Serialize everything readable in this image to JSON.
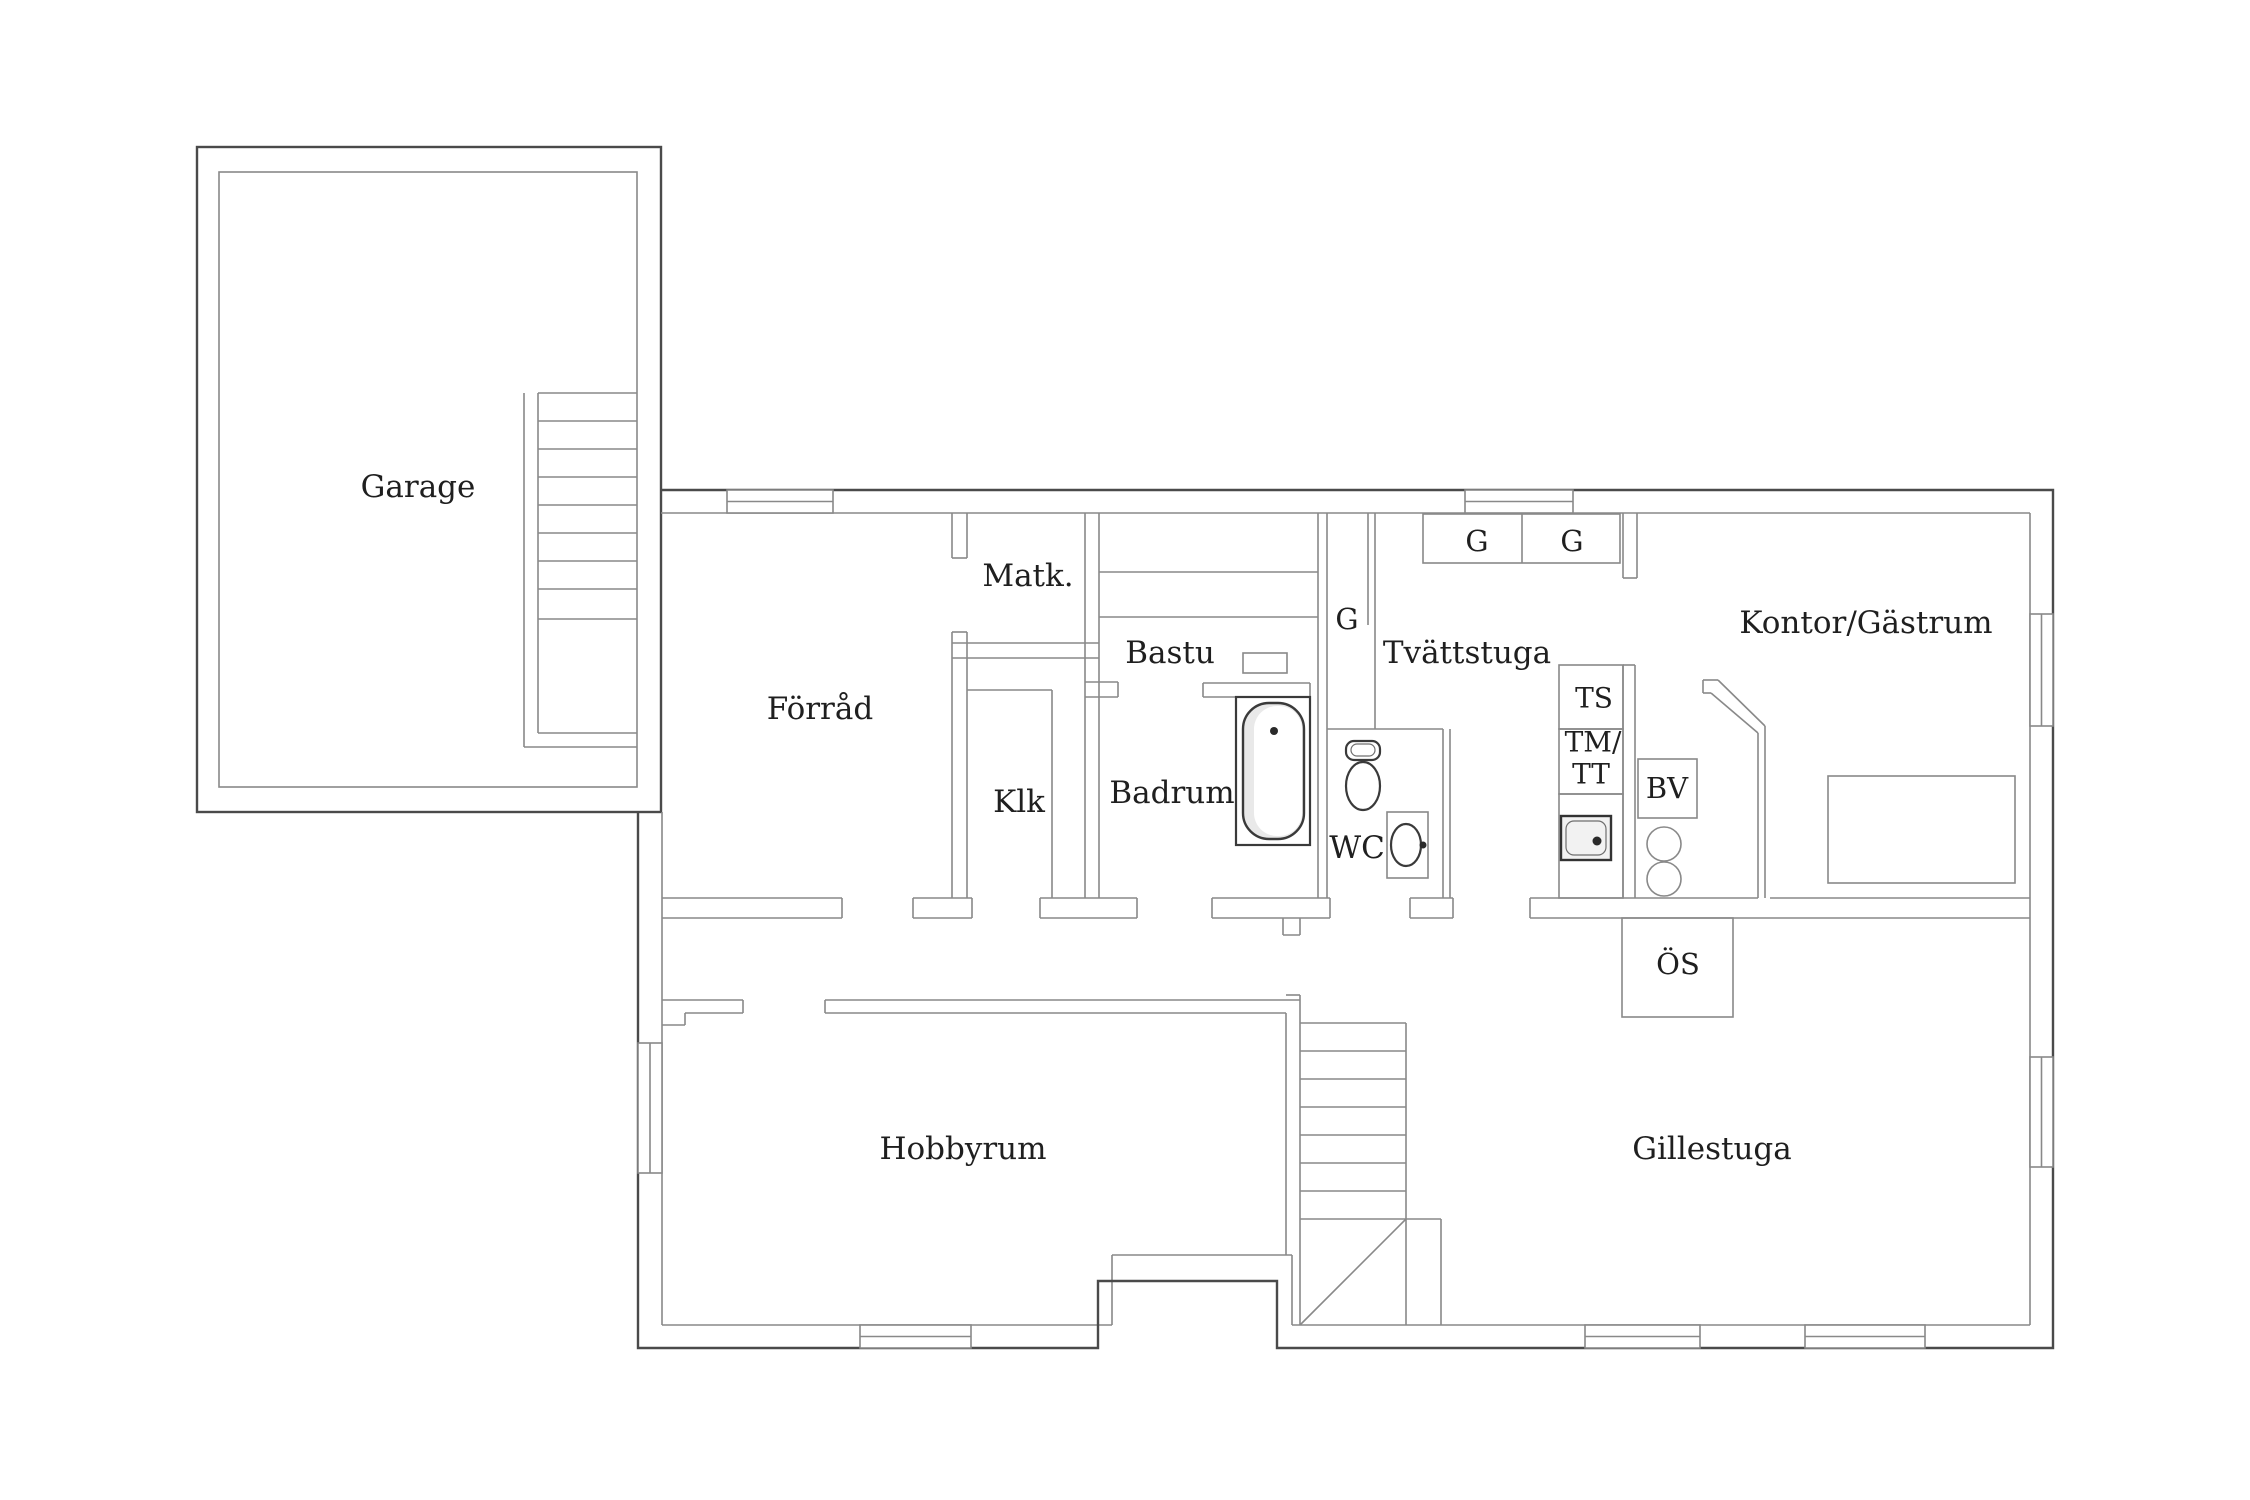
{
  "title": "Basement floor plan",
  "colors": {
    "background": "#ffffff",
    "wall": "#898989",
    "wall_dark": "#4a4a4a",
    "text": "#1f1f1f",
    "fixture_fill": "#e9e9e9"
  },
  "rooms": {
    "garage": "Garage",
    "forrad": "Förråd",
    "matk": "Matk.",
    "bastu": "Bastu",
    "klk": "Klk",
    "badrum": "Badrum",
    "wc": "WC",
    "g_closet": "G",
    "tvattstuga": "Tvättstuga",
    "g1": "G",
    "g2": "G",
    "ts": "TS",
    "tm1": "TM/",
    "tm2": "TT",
    "bv": "BV",
    "os": "ÖS",
    "kontor": "Kontor/Gästrum",
    "gillestuga": "Gillestuga",
    "hobbyrum": "Hobbyrum"
  },
  "plan": {
    "width": 2250,
    "height": 1500,
    "labels": [
      {
        "key": "garage",
        "x": 418,
        "y": 487,
        "size": 31
      },
      {
        "key": "forrad",
        "x": 820,
        "y": 709,
        "size": 31
      },
      {
        "key": "matk",
        "x": 1028,
        "y": 576,
        "size": 31
      },
      {
        "key": "bastu",
        "x": 1170,
        "y": 653,
        "size": 31
      },
      {
        "key": "klk",
        "x": 1019,
        "y": 802,
        "size": 31
      },
      {
        "key": "badrum",
        "x": 1172,
        "y": 793,
        "size": 31
      },
      {
        "key": "wc",
        "x": 1357,
        "y": 848,
        "size": 31
      },
      {
        "key": "g_closet",
        "x": 1347,
        "y": 619,
        "size": 29
      },
      {
        "key": "tvattstuga",
        "x": 1467,
        "y": 653,
        "size": 31
      },
      {
        "key": "g1",
        "x": 1477,
        "y": 541,
        "size": 29
      },
      {
        "key": "g2",
        "x": 1572,
        "y": 541,
        "size": 29
      },
      {
        "key": "ts",
        "x": 1594,
        "y": 698,
        "size": 28
      },
      {
        "key": "tm1",
        "x": 1593,
        "y": 742,
        "size": 28
      },
      {
        "key": "tm2",
        "x": 1591,
        "y": 774,
        "size": 28
      },
      {
        "key": "bv",
        "x": 1667,
        "y": 788,
        "size": 29
      },
      {
        "key": "os",
        "x": 1678,
        "y": 964,
        "size": 29
      },
      {
        "key": "kontor",
        "x": 1866,
        "y": 623,
        "size": 31
      },
      {
        "key": "gillestuga",
        "x": 1712,
        "y": 1149,
        "size": 31
      },
      {
        "key": "hobbyrum",
        "x": 963,
        "y": 1149,
        "size": 31
      }
    ],
    "paths": [
      {
        "d": "M661 490H2053V1348H1277V1281H1098V1348H638V812",
        "c": "d",
        "name": "exterior-wall"
      },
      {
        "d": "M1718 680L1765 726",
        "c": "w",
        "name": "chimney-diagonal"
      },
      {
        "d": "M1711 693L1758 733",
        "c": "w",
        "name": "chimney-diagonal"
      },
      {
        "d": "M1300 1325L1406 1219",
        "c": "w",
        "name": "stairs-winder-diagonal"
      }
    ],
    "rects": [
      {
        "x": 197,
        "y": 147,
        "w": 464,
        "h": 665,
        "c": "d",
        "name": "garage-outer-wall"
      },
      {
        "x": 219,
        "y": 172,
        "w": 418,
        "h": 615,
        "c": "w",
        "name": "garage-inner-wall"
      },
      {
        "x": 1423,
        "y": 514,
        "w": 197,
        "h": 49,
        "c": "w",
        "name": "wardrobe-cabinets"
      },
      {
        "x": 1559,
        "y": 665,
        "w": 64,
        "h": 64,
        "c": "w",
        "name": "ts-unit"
      },
      {
        "x": 1559,
        "y": 729,
        "w": 64,
        "h": 65,
        "c": "w",
        "name": "tm-tt-unit"
      },
      {
        "x": 1559,
        "y": 794,
        "w": 64,
        "h": 104,
        "c": "w",
        "name": "sink-counter"
      },
      {
        "x": 1638,
        "y": 759,
        "w": 59,
        "h": 59,
        "c": "w",
        "name": "bv-unit"
      },
      {
        "x": 1622,
        "y": 918,
        "w": 111,
        "h": 99,
        "c": "w",
        "name": "fireplace"
      },
      {
        "x": 1828,
        "y": 776,
        "w": 187,
        "h": 107,
        "c": "w",
        "name": "desk"
      },
      {
        "x": 1243,
        "y": 653,
        "w": 44,
        "h": 20,
        "c": "w",
        "name": "sauna-heater"
      }
    ],
    "windows": [
      {
        "x": 727,
        "y": 490,
        "w": 106,
        "h": 23,
        "o": "h",
        "name": "window-top-forrad"
      },
      {
        "x": 1465,
        "y": 490,
        "w": 108,
        "h": 23,
        "o": "h",
        "name": "window-top-tvattstuga"
      },
      {
        "x": 2030,
        "y": 614,
        "w": 23,
        "h": 112,
        "o": "v",
        "name": "window-east-kontor"
      },
      {
        "x": 2030,
        "y": 1057,
        "w": 23,
        "h": 110,
        "o": "v",
        "name": "window-east-gillestuga"
      },
      {
        "x": 1585,
        "y": 1325,
        "w": 115,
        "h": 23,
        "o": "h",
        "name": "window-south-gillestuga-1"
      },
      {
        "x": 1805,
        "y": 1325,
        "w": 120,
        "h": 23,
        "o": "h",
        "name": "window-south-gillestuga-2"
      },
      {
        "x": 860,
        "y": 1325,
        "w": 111,
        "h": 23,
        "o": "h",
        "name": "window-south-hobbyrum"
      },
      {
        "x": 638,
        "y": 1043,
        "w": 24,
        "h": 130,
        "o": "v",
        "name": "window-west-hobbyrum"
      }
    ],
    "lines": [
      [
        524,
        393,
        524,
        747
      ],
      [
        538,
        393,
        538,
        733
      ],
      [
        538,
        393,
        637,
        393
      ],
      [
        538,
        421,
        637,
        421
      ],
      [
        538,
        449,
        637,
        449
      ],
      [
        538,
        477,
        637,
        477
      ],
      [
        538,
        505,
        637,
        505
      ],
      [
        538,
        533,
        637,
        533
      ],
      [
        538,
        561,
        637,
        561
      ],
      [
        538,
        589,
        637,
        589
      ],
      [
        538,
        619,
        637,
        619
      ],
      [
        538,
        733,
        637,
        733
      ],
      [
        524,
        747,
        637,
        747
      ],
      [
        661,
        513,
        2030,
        513
      ],
      [
        2030,
        513,
        2030,
        1325
      ],
      [
        1292,
        1325,
        2030,
        1325
      ],
      [
        1292,
        1255,
        1292,
        1325
      ],
      [
        1112,
        1255,
        1292,
        1255
      ],
      [
        1112,
        1255,
        1112,
        1325
      ],
      [
        662,
        1325,
        1112,
        1325
      ],
      [
        662,
        812,
        662,
        1325
      ],
      [
        662,
        898,
        842,
        898
      ],
      [
        662,
        918,
        842,
        918
      ],
      [
        842,
        898,
        842,
        918
      ],
      [
        913,
        898,
        972,
        898
      ],
      [
        913,
        918,
        972,
        918
      ],
      [
        913,
        898,
        913,
        918
      ],
      [
        972,
        898,
        972,
        918
      ],
      [
        1040,
        898,
        1137,
        898
      ],
      [
        1040,
        918,
        1137,
        918
      ],
      [
        1040,
        898,
        1040,
        918
      ],
      [
        1137,
        898,
        1137,
        918
      ],
      [
        1212,
        898,
        1330,
        898
      ],
      [
        1212,
        918,
        1330,
        918
      ],
      [
        1212,
        898,
        1212,
        918
      ],
      [
        1330,
        898,
        1330,
        918
      ],
      [
        1283,
        918,
        1283,
        935
      ],
      [
        1300,
        918,
        1300,
        935
      ],
      [
        1283,
        935,
        1300,
        935
      ],
      [
        1410,
        898,
        1453,
        898
      ],
      [
        1410,
        918,
        1453,
        918
      ],
      [
        1410,
        898,
        1410,
        918
      ],
      [
        1453,
        898,
        1453,
        918
      ],
      [
        1530,
        898,
        1758,
        898
      ],
      [
        1530,
        918,
        2030,
        918
      ],
      [
        1530,
        898,
        1530,
        918
      ],
      [
        1770,
        898,
        2030,
        898
      ],
      [
        952,
        513,
        952,
        558
      ],
      [
        967,
        513,
        967,
        558
      ],
      [
        952,
        558,
        967,
        558
      ],
      [
        952,
        632,
        952,
        898
      ],
      [
        967,
        632,
        967,
        898
      ],
      [
        952,
        632,
        967,
        632
      ],
      [
        952,
        643,
        1099,
        643
      ],
      [
        952,
        658,
        1099,
        658
      ],
      [
        967,
        690,
        1052,
        690
      ],
      [
        1052,
        690,
        1052,
        898
      ],
      [
        1085,
        513,
        1085,
        898
      ],
      [
        1099,
        513,
        1099,
        898
      ],
      [
        1085,
        682,
        1118,
        682
      ],
      [
        1085,
        697,
        1118,
        697
      ],
      [
        1118,
        682,
        1118,
        697
      ],
      [
        1099,
        572,
        1318,
        572
      ],
      [
        1099,
        617,
        1318,
        617
      ],
      [
        1203,
        683,
        1310,
        683
      ],
      [
        1203,
        697,
        1310,
        697
      ],
      [
        1203,
        683,
        1203,
        697
      ],
      [
        1310,
        683,
        1310,
        697
      ],
      [
        1318,
        513,
        1318,
        898
      ],
      [
        1327,
        513,
        1327,
        898
      ],
      [
        1368,
        513,
        1368,
        625
      ],
      [
        1375,
        513,
        1375,
        729
      ],
      [
        1327,
        729,
        1443,
        729
      ],
      [
        1443,
        729,
        1443,
        898
      ],
      [
        1450,
        729,
        1450,
        898
      ],
      [
        1623,
        513,
        1623,
        578
      ],
      [
        1637,
        513,
        1637,
        578
      ],
      [
        1623,
        578,
        1637,
        578
      ],
      [
        1623,
        665,
        1623,
        898
      ],
      [
        1635,
        665,
        1635,
        898
      ],
      [
        1623,
        665,
        1635,
        665
      ],
      [
        1703,
        680,
        1718,
        680
      ],
      [
        1703,
        680,
        1703,
        693
      ],
      [
        1703,
        693,
        1711,
        693
      ],
      [
        1765,
        726,
        1765,
        898
      ],
      [
        1758,
        733,
        1758,
        898
      ],
      [
        662,
        1000,
        743,
        1000
      ],
      [
        685,
        1013,
        743,
        1013
      ],
      [
        743,
        1000,
        743,
        1013
      ],
      [
        685,
        1013,
        685,
        1025
      ],
      [
        662,
        1025,
        685,
        1025
      ],
      [
        825,
        1000,
        1300,
        1000
      ],
      [
        825,
        1013,
        1286,
        1013
      ],
      [
        825,
        1000,
        825,
        1013
      ],
      [
        1286,
        1013,
        1286,
        1255
      ],
      [
        1300,
        995,
        1300,
        1325
      ],
      [
        1286,
        995,
        1300,
        995
      ],
      [
        1406,
        1023,
        1406,
        1325
      ],
      [
        1300,
        1023,
        1406,
        1023
      ],
      [
        1300,
        1051,
        1406,
        1051
      ],
      [
        1300,
        1079,
        1406,
        1079
      ],
      [
        1300,
        1107,
        1406,
        1107
      ],
      [
        1300,
        1135,
        1406,
        1135
      ],
      [
        1300,
        1163,
        1406,
        1163
      ],
      [
        1300,
        1191,
        1406,
        1191
      ],
      [
        1300,
        1219,
        1406,
        1219
      ],
      [
        1441,
        1219,
        1441,
        1325
      ],
      [
        1406,
        1219,
        1441,
        1219
      ],
      [
        1522,
        514,
        1522,
        563
      ],
      [
        1413,
        845,
        1423,
        845
      ],
      [
        1605,
        823,
        1594,
        840
      ]
    ],
    "fixtures": {
      "tub_outer": {
        "x": 1236,
        "y": 697,
        "w": 74,
        "h": 148
      },
      "tub_inner": {
        "x": 1243,
        "y": 703,
        "w": 61,
        "h": 136,
        "rx": 26
      },
      "tub_highlight": {
        "x": 1254,
        "y": 706,
        "w": 48,
        "h": 130,
        "rx": 23
      },
      "tub_drain": {
        "cx": 1274,
        "cy": 731,
        "r": 4
      },
      "toilet_tank": {
        "x": 1346,
        "y": 741,
        "w": 34,
        "h": 19,
        "rx": 8
      },
      "toilet_tank_inner": {
        "x": 1351,
        "y": 744,
        "w": 24,
        "h": 12,
        "rx": 6
      },
      "toilet_bowl": {
        "cx": 1363,
        "cy": 786,
        "rx": 17,
        "ry": 24
      },
      "basin_box": {
        "x": 1387,
        "y": 812,
        "w": 41,
        "h": 66
      },
      "basin_bowl": {
        "cx": 1406,
        "cy": 845,
        "rx": 15,
        "ry": 21
      },
      "basin_faucet": {
        "cx": 1423,
        "cy": 845,
        "r": 3.5
      },
      "sink_box": {
        "x": 1561,
        "y": 816,
        "w": 50,
        "h": 44
      },
      "sink_inner": {
        "x": 1566,
        "y": 821,
        "w": 40,
        "h": 34,
        "rx": 8
      },
      "sink_knob": {
        "cx": 1597,
        "cy": 841,
        "r": 4.5
      }
    }
  }
}
